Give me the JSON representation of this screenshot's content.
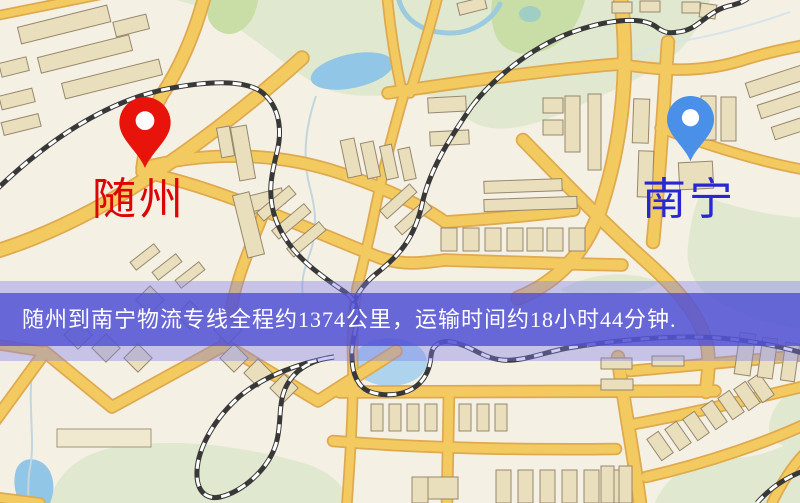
{
  "map": {
    "origin": {
      "name": "随州",
      "pin_color": "#e8130b",
      "label_color": "#dd0404",
      "marker": "red-map-pin"
    },
    "destination": {
      "name": "南宁",
      "pin_color": "#4a90e8",
      "label_color": "#2727d4",
      "marker": "blue-map-pin"
    },
    "style_colors": {
      "background": "#f5f0e4",
      "road": "#f3ca60",
      "road_casing": "#dfa94f",
      "park": "#e0e9cf",
      "water": "#92c6e6",
      "building": "#eadfbd",
      "railway": "#383838"
    }
  },
  "banner": {
    "text": "随州到南宁物流专线全程约1374公里，运输时间约18小时44分钟.",
    "distance_km": "1374",
    "duration_hours": "18",
    "duration_minutes": "44",
    "background_color": "#5050d4",
    "text_color": "#ffffff"
  }
}
